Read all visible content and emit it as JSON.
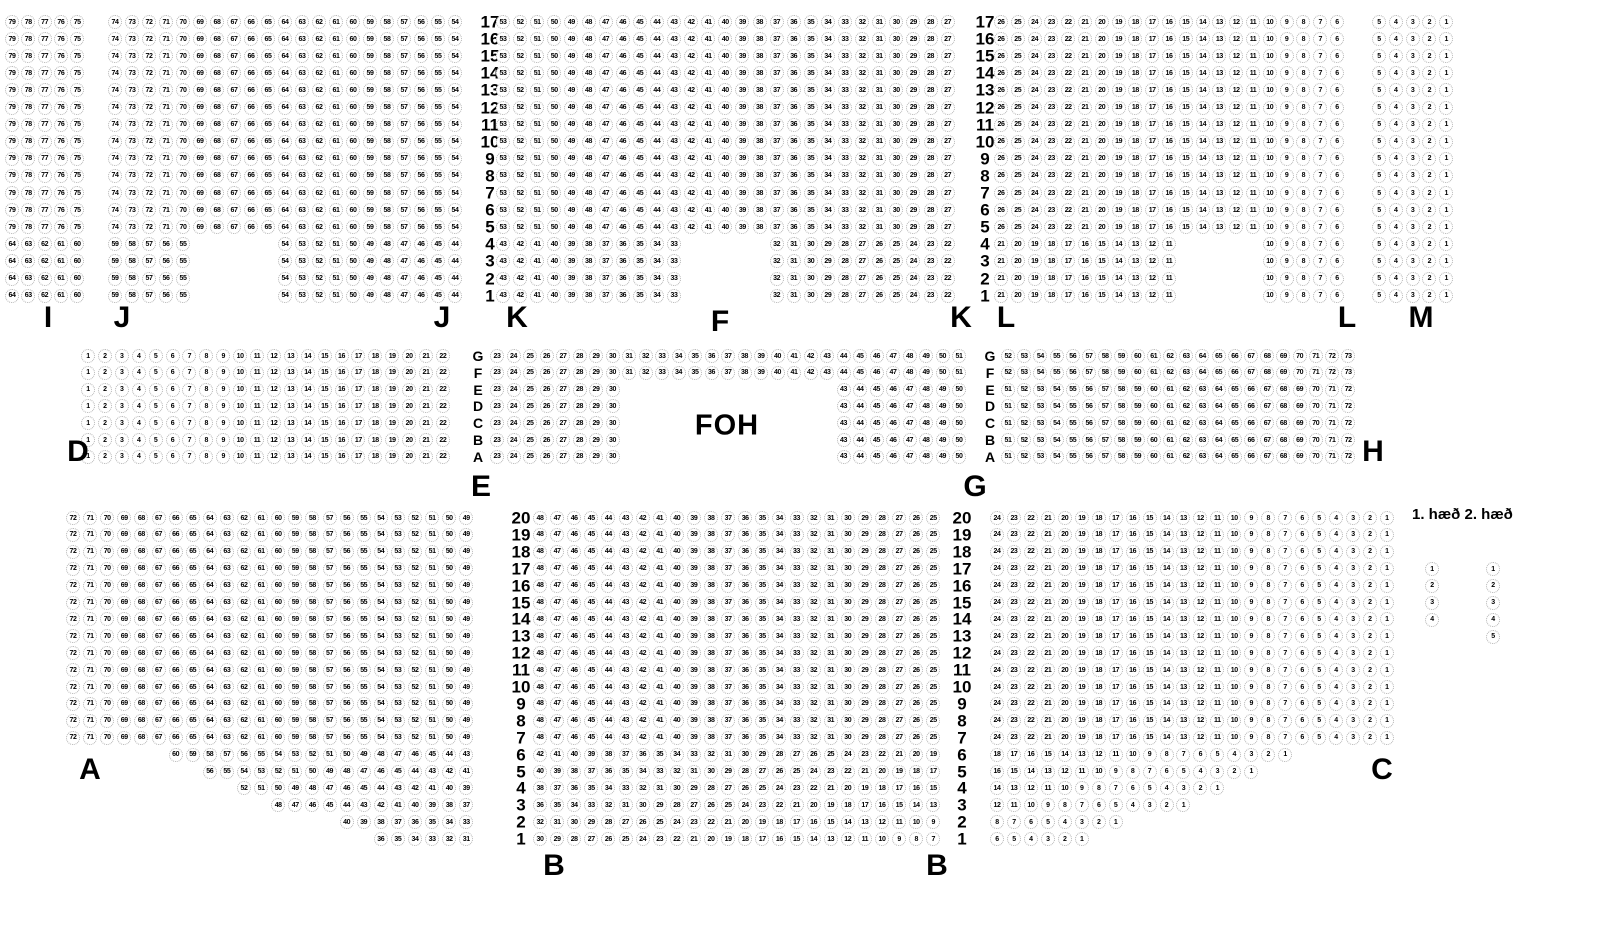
{
  "colors": {
    "background": "#ffffff",
    "seat_ring": "#b2b2b2",
    "text": "#000000"
  },
  "legend": {
    "heading": "1. hæð 2. hæð",
    "columns": [
      {
        "name": "1. hæð",
        "items": [
          "1",
          "2",
          "3",
          "4"
        ]
      },
      {
        "name": "2. hæð",
        "items": [
          "1",
          "2",
          "3",
          "4",
          "5"
        ]
      }
    ]
  },
  "seat_map": {
    "blocks": [
      {
        "name": "balcony-section-I-seats",
        "type": "seats",
        "x": 12,
        "y": 22,
        "dx": 16.3,
        "dy": 17.1,
        "rows": [
          {
            "repeat": 13,
            "seats": "79 78 77 76 75"
          },
          {
            "repeat": 4,
            "seats": "64 63 62 61 60"
          }
        ]
      },
      {
        "name": "balcony-section-J-seats",
        "type": "seats",
        "x": 115,
        "y": 22,
        "dx": 17,
        "dy": 17.1,
        "rows": [
          {
            "repeat": 13,
            "seats": "74 73 72 71 70 69 68 67 66 65 64 63 62 61 60 59 58 57 56 55 54"
          },
          {
            "repeat": 4,
            "segments": [
              {
                "col": 0,
                "seats": "59 58 57 56 55"
              },
              {
                "col": 10,
                "seats": "54 53 52 51 50 49 48 47 46 45 44"
              }
            ]
          }
        ]
      },
      {
        "name": "row-labels-balcony-left",
        "type": "labels",
        "cls": "num",
        "x": 490,
        "y": 22,
        "dy": 17.1,
        "items": [
          "17",
          "16",
          "15",
          "14",
          "13",
          "12",
          "11",
          "10",
          "9",
          "8",
          "7",
          "6",
          "5",
          "4",
          "3",
          "2",
          "1"
        ]
      },
      {
        "name": "balcony-section-K-seats",
        "type": "seats",
        "x": 503,
        "y": 22,
        "dx": 17.1,
        "dy": 17.1,
        "rows": [
          {
            "repeat": 13,
            "seats": "53 52 51 50 49 48 47 46 45 44 43 42 41 40 39 38 37 36 35 34 33 32 31 30 29 28 27"
          },
          {
            "repeat": 4,
            "segments": [
              {
                "col": 0,
                "seats": "43 42 41 40 39 38 37 36 35 34 33"
              },
              {
                "col": 16,
                "seats": "32 31 30 29 28 27 26 25 24 23 22"
              }
            ]
          }
        ]
      },
      {
        "name": "row-labels-balcony-right",
        "type": "labels",
        "cls": "num",
        "x": 985,
        "y": 22,
        "dy": 17.1,
        "items": [
          "17",
          "16",
          "15",
          "14",
          "13",
          "12",
          "11",
          "10",
          "9",
          "8",
          "7",
          "6",
          "5",
          "4",
          "3",
          "2",
          "1"
        ]
      },
      {
        "name": "balcony-section-L-seats",
        "type": "seats",
        "x": 1001,
        "y": 22,
        "dx": 16.8,
        "dy": 17.1,
        "rows": [
          {
            "repeat": 13,
            "seats": "26 25 24 23 22 21 20 19 18 17 16 15 14 13 12 11 10 9 8 7 6"
          },
          {
            "repeat": 4,
            "segments": [
              {
                "col": 0,
                "seats": "21 20 19 18 17 16 15 14 13 12 11"
              },
              {
                "col": 16,
                "seats": "10 9 8 7 6"
              }
            ]
          }
        ]
      },
      {
        "name": "balcony-section-M-seats",
        "type": "seats",
        "x": 1379,
        "y": 22,
        "dx": 16.8,
        "dy": 17.1,
        "rows": [
          {
            "repeat": 17,
            "seats": "5 4 3 2 1"
          }
        ]
      },
      {
        "name": "mid-section-D-seats",
        "type": "seats",
        "x": 88,
        "y": 356,
        "dx": 16.9,
        "dy": 16.8,
        "rows": [
          {
            "repeat": 7,
            "seats": "1 2 3 4 5 6 7 8 9 10 11 12 13 14 15 16 17 18 19 20 21 22"
          }
        ]
      },
      {
        "name": "row-letters-mid-left",
        "type": "labels",
        "cls": "letter",
        "x": 478,
        "y": 356,
        "dy": 16.8,
        "items": [
          "G",
          "F",
          "E",
          "D",
          "C",
          "B",
          "A"
        ]
      },
      {
        "name": "mid-section-E-seats",
        "type": "seats",
        "x": 497,
        "y": 356,
        "dx": 16.5,
        "dy": 16.8,
        "rows": [
          {
            "repeat": 2,
            "seats": "23 24 25 26 27 28 29 30 31 32 33 34 35 36 37 38 39 40 41 42 43 44 45 46 47 48 49 50 51"
          },
          {
            "repeat": 5,
            "segments": [
              {
                "col": 0,
                "seats": "23 24 25 26 27 28 29 30"
              },
              {
                "col": 21,
                "seats": "43 44 45 46 47 48 49 50"
              }
            ]
          }
        ]
      },
      {
        "name": "row-letters-mid-right",
        "type": "labels",
        "cls": "letter",
        "x": 990,
        "y": 356,
        "dy": 16.8,
        "items": [
          "G",
          "F",
          "E",
          "D",
          "C",
          "B",
          "A"
        ]
      },
      {
        "name": "mid-section-H-seats",
        "type": "seats",
        "x": 1008,
        "y": 356,
        "dx": 16.2,
        "dy": 16.8,
        "rows": [
          {
            "repeat": 2,
            "seats": "52 53 54 55 56 57 58 59 60 61 62 63 64 65 66 67 68 69 70 71 72 73"
          },
          {
            "repeat": 5,
            "seats": "51 52 53 54 55 56 57 58 59 60 61 62 63 64 65 66 67 68 69 70 71 72"
          }
        ]
      },
      {
        "name": "stalls-section-A-seats",
        "type": "seats",
        "x": 73,
        "y": 518,
        "dx": 17.1,
        "dy": 16.9,
        "rows": [
          {
            "repeat": 14,
            "seats": "72 71 70 69 68 67 66 65 64 63 62 61 60 59 58 57 56 55 54 53 52 51 50 49"
          },
          {
            "col": 6,
            "seats": "60 59 58 57 56 55 54 53 52 51 50 49 48 47 46 45 44 43"
          },
          {
            "col": 8,
            "seats": "56 55 54 53 52 51 50 49 48 47 46 45 44 43 42 41"
          },
          {
            "col": 10,
            "seats": "52 51 50 49 48 47 46 45 44 43 42 41 40 39"
          },
          {
            "col": 12,
            "seats": "48 47 46 45 44 43 42 41 40 39 38 37"
          },
          {
            "col": 16,
            "seats": "40 39 38 37 36 35 34 33"
          },
          {
            "col": 18,
            "seats": "36 35 34 33 32 31"
          }
        ]
      },
      {
        "name": "row-labels-stalls-left",
        "type": "labels",
        "cls": "num",
        "x": 521,
        "y": 518,
        "dy": 16.9,
        "items": [
          "20",
          "19",
          "18",
          "17",
          "16",
          "15",
          "14",
          "13",
          "12",
          "11",
          "10",
          "9",
          "8",
          "7",
          "6",
          "5",
          "4",
          "3",
          "2",
          "1"
        ]
      },
      {
        "name": "stalls-section-B-seats",
        "type": "seats",
        "x": 540,
        "y": 518,
        "dx": 17.1,
        "dy": 16.9,
        "rows": [
          {
            "repeat": 14,
            "seats": "48 47 46 45 44 43 42 41 40 39 38 37 36 35 34 33 32 31 30 29 28 27 26 25"
          },
          {
            "seats": "42 41 40 39 38 37 36 35 34 33 32 31 30 29 28 27 26 25 24 23 22 21 20 19"
          },
          {
            "seats": "40 39 38 37 36 35 34 33 32 31 30 29 28 27 26 25 24 23 22 21 20 19 18 17"
          },
          {
            "seats": "38 37 36 35 34 33 32 31 30 29 28 27 26 25 24 23 22 21 20 19 18 17 16 15"
          },
          {
            "seats": "36 35 34 33 32 31 30 29 28 27 26 25 24 23 22 21 20 19 18 17 16 15 14 13"
          },
          {
            "seats": "32 31 30 29 28 27 26 25 24 23 22 21 20 19 18 17 16 15 14 13 12 11 10 9"
          },
          {
            "seats": "30 29 28 27 26 25 24 23 22 21 20 19 18 17 16 15 14 13 12 11 10 9 8 7"
          }
        ]
      },
      {
        "name": "row-labels-stalls-right",
        "type": "labels",
        "cls": "num",
        "x": 962,
        "y": 518,
        "dy": 16.9,
        "items": [
          "20",
          "19",
          "18",
          "17",
          "16",
          "15",
          "14",
          "13",
          "12",
          "11",
          "10",
          "9",
          "8",
          "7",
          "6",
          "5",
          "4",
          "3",
          "2",
          "1"
        ]
      },
      {
        "name": "stalls-section-C-seats",
        "type": "seats",
        "x": 997,
        "y": 518,
        "dx": 16.95,
        "dy": 16.9,
        "rows": [
          {
            "repeat": 14,
            "seats": "24 23 22 21 20 19 18 17 16 15 14 13 12 11 10 9 8 7 6 5 4 3 2 1"
          },
          {
            "seats": "18 17 16 15 14 13 12 11 10 9 8 7 6 5 4 3 2 1"
          },
          {
            "seats": "16 15 14 13 12 11 10 9 8 7 6 5 4 3 2 1"
          },
          {
            "seats": "14 13 12 11 10 9 8 7 6 5 4 3 2 1"
          },
          {
            "seats": "12 11 10 9 8 7 6 5 4 3 2 1"
          },
          {
            "seats": "8 7 6 5 4 3 2 1"
          },
          {
            "seats": "6 5 4 3 2 1"
          }
        ]
      },
      {
        "name": "section-label-I",
        "type": "text",
        "cls": "section",
        "text": "I",
        "x": 48,
        "y": 318
      },
      {
        "name": "section-label-J-left",
        "type": "text",
        "cls": "section",
        "text": "J",
        "x": 122,
        "y": 318
      },
      {
        "name": "section-label-J-right",
        "type": "text",
        "cls": "section",
        "text": "J",
        "x": 442,
        "y": 318
      },
      {
        "name": "section-label-K-left",
        "type": "text",
        "cls": "section",
        "text": "K",
        "x": 517,
        "y": 318
      },
      {
        "name": "section-label-F",
        "type": "text",
        "cls": "section",
        "text": "F",
        "x": 720,
        "y": 322
      },
      {
        "name": "section-label-K-right",
        "type": "text",
        "cls": "section",
        "text": "K",
        "x": 961,
        "y": 318
      },
      {
        "name": "section-label-L-left",
        "type": "text",
        "cls": "section",
        "text": "L",
        "x": 1006,
        "y": 318
      },
      {
        "name": "section-label-L-right",
        "type": "text",
        "cls": "section",
        "text": "L",
        "x": 1347,
        "y": 318
      },
      {
        "name": "section-label-M",
        "type": "text",
        "cls": "section",
        "text": "M",
        "x": 1421,
        "y": 318
      },
      {
        "name": "section-label-D",
        "type": "text",
        "cls": "section",
        "text": "D",
        "x": 78,
        "y": 452
      },
      {
        "name": "section-label-E",
        "type": "text",
        "cls": "section",
        "text": "E",
        "x": 481,
        "y": 487
      },
      {
        "name": "section-label-G",
        "type": "text",
        "cls": "section",
        "text": "G",
        "x": 975,
        "y": 487
      },
      {
        "name": "section-label-H",
        "type": "text",
        "cls": "section",
        "text": "H",
        "x": 1373,
        "y": 452
      },
      {
        "name": "section-label-A",
        "type": "text",
        "cls": "section",
        "text": "A",
        "x": 90,
        "y": 770
      },
      {
        "name": "section-label-B-left",
        "type": "text",
        "cls": "section",
        "text": "B",
        "x": 554,
        "y": 866
      },
      {
        "name": "section-label-B-right",
        "type": "text",
        "cls": "section",
        "text": "B",
        "x": 937,
        "y": 866
      },
      {
        "name": "section-label-C",
        "type": "text",
        "cls": "section",
        "text": "C",
        "x": 1382,
        "y": 770
      },
      {
        "name": "foh-label",
        "type": "text",
        "cls": "foh",
        "text": "FOH",
        "x": 727,
        "y": 426
      },
      {
        "name": "legend-seats-floor-1",
        "type": "seats",
        "legend": true,
        "x": 1432,
        "y": 569,
        "dx": 17,
        "dy": 16.9,
        "rows": [
          {
            "seats": "1"
          },
          {
            "seats": "2"
          },
          {
            "seats": "3"
          },
          {
            "seats": "4"
          }
        ]
      },
      {
        "name": "legend-seats-floor-2",
        "type": "seats",
        "legend": true,
        "x": 1493,
        "y": 569,
        "dx": 17,
        "dy": 16.9,
        "rows": [
          {
            "seats": "1"
          },
          {
            "seats": "2"
          },
          {
            "seats": "3"
          },
          {
            "seats": "4"
          },
          {
            "seats": "5"
          }
        ]
      }
    ]
  }
}
